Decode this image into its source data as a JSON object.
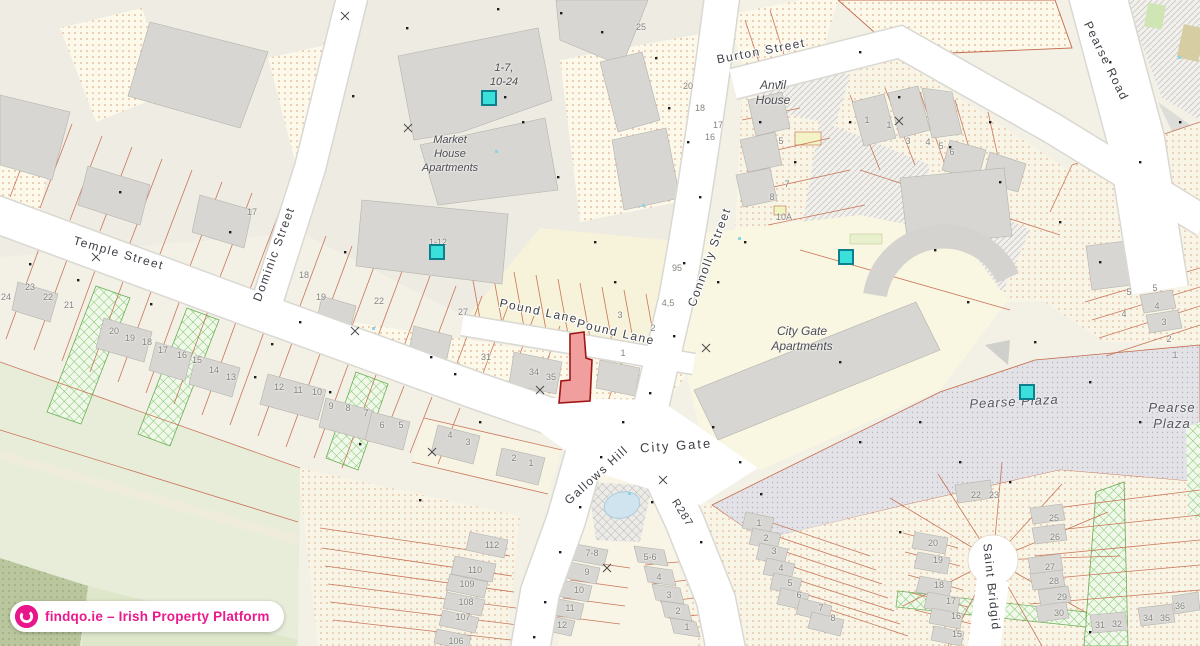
{
  "map": {
    "attribution": "findqo.ie – Irish Property Platform",
    "streets": {
      "temple": "Temple Street",
      "dominic": "Dominic Street",
      "pound1": "Pound Lane",
      "pound2": "Pound Lane",
      "connolly": "Connolly Street",
      "burton": "Burton Street",
      "pearse_road": "Pearse Road",
      "gallows": "Gallows Hill",
      "r287": "R287",
      "city_gate": "City Gate",
      "saint_bridgid": "Saint Bridgid"
    },
    "places": {
      "market_house": "Market\nHouse\nApartments",
      "units_1_7_10_24": "1-7,\n10-24",
      "anvil_house": "Anvil\nHouse",
      "city_gate_apartments": "City Gate\nApartments",
      "pearse_plaza": "Pearse Plaza",
      "pearse_plaza_2": "Pearse\nPlaza"
    },
    "colors": {
      "road": "#ffffff",
      "parcel_line": "#c4694a",
      "building": "#d7d6d2",
      "cream_parcel": "#f8f4e4",
      "green_hatch": "#7cc266",
      "plaza": "#e3e2e7",
      "marker_fill": "#3be0da",
      "marker_border": "#0e7f8c",
      "subject_fill": "#f09e9e",
      "subject_stroke": "#9e1515",
      "brand_pink": "#ea1a8d",
      "water": "#cfe4ef"
    },
    "markers": [
      {
        "x": 489,
        "y": 98
      },
      {
        "x": 437,
        "y": 252
      },
      {
        "x": 846,
        "y": 257
      },
      {
        "x": 1027,
        "y": 392
      }
    ],
    "numbers": [
      {
        "t": "17",
        "x": 252,
        "y": 212
      },
      {
        "t": "18",
        "x": 304,
        "y": 275
      },
      {
        "t": "19",
        "x": 321,
        "y": 297
      },
      {
        "t": "24",
        "x": 6,
        "y": 297
      },
      {
        "t": "23",
        "x": 30,
        "y": 287
      },
      {
        "t": "22",
        "x": 48,
        "y": 297
      },
      {
        "t": "21",
        "x": 69,
        "y": 305
      },
      {
        "t": "20",
        "x": 114,
        "y": 331
      },
      {
        "t": "19",
        "x": 130,
        "y": 338
      },
      {
        "t": "18",
        "x": 147,
        "y": 342
      },
      {
        "t": "17",
        "x": 163,
        "y": 350
      },
      {
        "t": "16",
        "x": 182,
        "y": 355
      },
      {
        "t": "15",
        "x": 197,
        "y": 360
      },
      {
        "t": "14",
        "x": 214,
        "y": 370
      },
      {
        "t": "13",
        "x": 231,
        "y": 377
      },
      {
        "t": "12",
        "x": 279,
        "y": 387
      },
      {
        "t": "11",
        "x": 298,
        "y": 390
      },
      {
        "t": "10",
        "x": 317,
        "y": 392
      },
      {
        "t": "9",
        "x": 331,
        "y": 406
      },
      {
        "t": "8",
        "x": 348,
        "y": 408
      },
      {
        "t": "7",
        "x": 366,
        "y": 413
      },
      {
        "t": "6",
        "x": 382,
        "y": 425
      },
      {
        "t": "5",
        "x": 401,
        "y": 425
      },
      {
        "t": "4",
        "x": 450,
        "y": 435
      },
      {
        "t": "3",
        "x": 468,
        "y": 442
      },
      {
        "t": "2",
        "x": 514,
        "y": 458
      },
      {
        "t": "1",
        "x": 531,
        "y": 463
      },
      {
        "t": "22",
        "x": 379,
        "y": 301
      },
      {
        "t": "27",
        "x": 463,
        "y": 312
      },
      {
        "t": "31",
        "x": 486,
        "y": 357
      },
      {
        "t": "34",
        "x": 534,
        "y": 372
      },
      {
        "t": "35",
        "x": 551,
        "y": 377
      },
      {
        "t": "3",
        "x": 620,
        "y": 315
      },
      {
        "t": "2",
        "x": 653,
        "y": 328
      },
      {
        "t": "1",
        "x": 623,
        "y": 353
      },
      {
        "t": "4,5",
        "x": 668,
        "y": 303
      },
      {
        "t": "95",
        "x": 677,
        "y": 268
      },
      {
        "t": "25",
        "x": 641,
        "y": 27
      },
      {
        "t": "20",
        "x": 688,
        "y": 86
      },
      {
        "t": "18",
        "x": 700,
        "y": 108
      },
      {
        "t": "17",
        "x": 718,
        "y": 125
      },
      {
        "t": "16",
        "x": 710,
        "y": 137
      },
      {
        "t": "5",
        "x": 781,
        "y": 141
      },
      {
        "t": "1",
        "x": 867,
        "y": 120
      },
      {
        "t": "1",
        "x": 889,
        "y": 125
      },
      {
        "t": "3",
        "x": 908,
        "y": 141
      },
      {
        "t": "4",
        "x": 928,
        "y": 142
      },
      {
        "t": "5",
        "x": 941,
        "y": 146
      },
      {
        "t": "6",
        "x": 952,
        "y": 152
      },
      {
        "t": "7",
        "x": 787,
        "y": 184
      },
      {
        "t": "8",
        "x": 772,
        "y": 197
      },
      {
        "t": "10A",
        "x": 784,
        "y": 217
      },
      {
        "t": "1-12",
        "x": 438,
        "y": 242
      },
      {
        "t": "5",
        "x": 1129,
        "y": 292
      },
      {
        "t": "5",
        "x": 1155,
        "y": 288
      },
      {
        "t": "4",
        "x": 1124,
        "y": 314
      },
      {
        "t": "4",
        "x": 1157,
        "y": 306
      },
      {
        "t": "3",
        "x": 1164,
        "y": 322
      },
      {
        "t": "2",
        "x": 1169,
        "y": 339
      },
      {
        "t": "1",
        "x": 1175,
        "y": 355
      },
      {
        "t": "112",
        "x": 492,
        "y": 545
      },
      {
        "t": "110",
        "x": 475,
        "y": 570
      },
      {
        "t": "109",
        "x": 467,
        "y": 584
      },
      {
        "t": "108",
        "x": 466,
        "y": 602
      },
      {
        "t": "107",
        "x": 463,
        "y": 617
      },
      {
        "t": "106",
        "x": 456,
        "y": 641
      },
      {
        "t": "7-8",
        "x": 592,
        "y": 553
      },
      {
        "t": "9",
        "x": 587,
        "y": 572
      },
      {
        "t": "10",
        "x": 579,
        "y": 590
      },
      {
        "t": "11",
        "x": 570,
        "y": 608
      },
      {
        "t": "12",
        "x": 562,
        "y": 625
      },
      {
        "t": "5-6",
        "x": 650,
        "y": 557
      },
      {
        "t": "4",
        "x": 659,
        "y": 577
      },
      {
        "t": "3",
        "x": 669,
        "y": 595
      },
      {
        "t": "2",
        "x": 678,
        "y": 611
      },
      {
        "t": "1",
        "x": 687,
        "y": 627
      },
      {
        "t": "1",
        "x": 759,
        "y": 523
      },
      {
        "t": "2",
        "x": 766,
        "y": 538
      },
      {
        "t": "3",
        "x": 774,
        "y": 551
      },
      {
        "t": "4",
        "x": 781,
        "y": 568
      },
      {
        "t": "5",
        "x": 790,
        "y": 583
      },
      {
        "t": "6",
        "x": 799,
        "y": 595
      },
      {
        "t": "7",
        "x": 821,
        "y": 608
      },
      {
        "t": "8",
        "x": 833,
        "y": 618
      },
      {
        "t": "22",
        "x": 976,
        "y": 495
      },
      {
        "t": "23",
        "x": 994,
        "y": 495
      },
      {
        "t": "25",
        "x": 1054,
        "y": 518
      },
      {
        "t": "26",
        "x": 1055,
        "y": 537
      },
      {
        "t": "27",
        "x": 1050,
        "y": 567
      },
      {
        "t": "28",
        "x": 1054,
        "y": 581
      },
      {
        "t": "29",
        "x": 1062,
        "y": 597
      },
      {
        "t": "30",
        "x": 1059,
        "y": 613
      },
      {
        "t": "20",
        "x": 933,
        "y": 543
      },
      {
        "t": "19",
        "x": 938,
        "y": 560
      },
      {
        "t": "18",
        "x": 939,
        "y": 585
      },
      {
        "t": "17",
        "x": 951,
        "y": 601
      },
      {
        "t": "16",
        "x": 956,
        "y": 616
      },
      {
        "t": "15",
        "x": 957,
        "y": 634
      },
      {
        "t": "31",
        "x": 1100,
        "y": 625
      },
      {
        "t": "32",
        "x": 1117,
        "y": 624
      },
      {
        "t": "34",
        "x": 1148,
        "y": 618
      },
      {
        "t": "35",
        "x": 1165,
        "y": 618
      },
      {
        "t": "36",
        "x": 1180,
        "y": 606
      }
    ]
  }
}
